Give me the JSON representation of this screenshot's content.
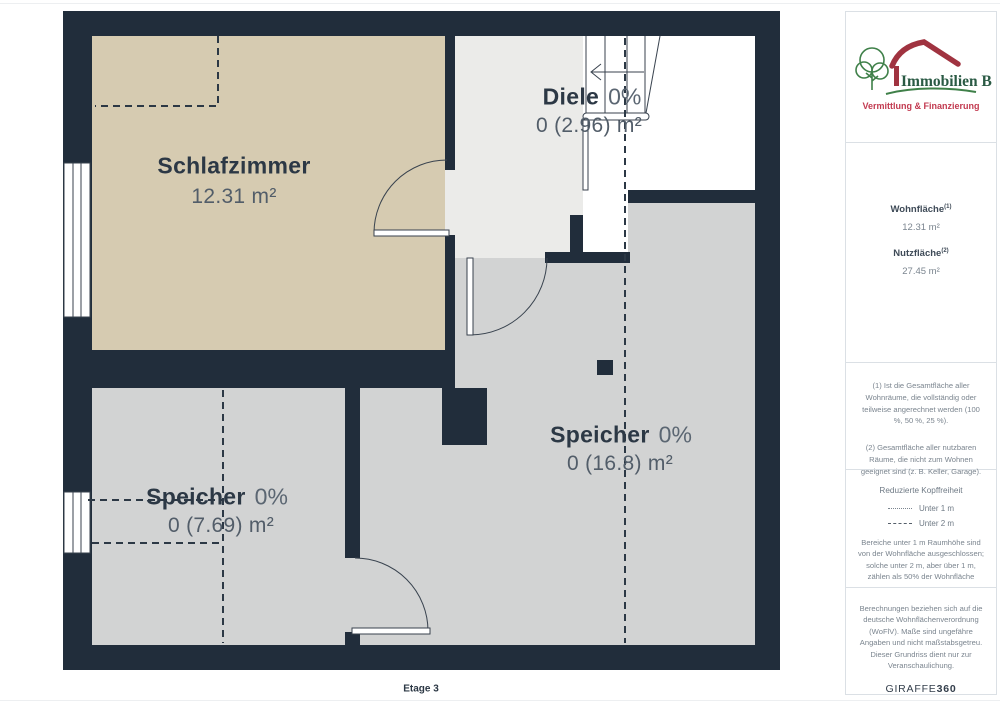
{
  "page": {
    "floor_label": "Etage 3"
  },
  "logo": {
    "name": "Immobilien Bart",
    "tagline": "Vermittlung & Finanzierung",
    "green": "#3f8049",
    "maroon": "#a03340",
    "red": "#c23a50"
  },
  "rooms": {
    "schlafzimmer": {
      "name": "Schlafzimmer",
      "area": "12.31 m²"
    },
    "diele": {
      "name": "Diele",
      "pct": "0%",
      "area": "0 (2.96) m²"
    },
    "speicher_right": {
      "name": "Speicher",
      "pct": "0%",
      "area": "0 (16.8) m²"
    },
    "speicher_left": {
      "name": "Speicher",
      "pct": "0%",
      "area": "0 (7.69) m²"
    }
  },
  "summary": {
    "wohnflaeche_label": "Wohnfläche",
    "wohnflaeche_sup": "(1)",
    "wohnflaeche_value": "12.31 m²",
    "nutzflaeche_label": "Nutzfläche",
    "nutzflaeche_sup": "(2)",
    "nutzflaeche_value": "27.45 m²"
  },
  "footnotes": {
    "note1": "(1) Ist die Gesamtfläche aller Wohnräume, die vollständig oder teilweise angerechnet werden (100 %, 50 %, 25 %).",
    "note2": "(2) Gesamtfläche aller nutzbaren Räume, die nicht zum Wohnen geeignet sind (z. B. Keller, Garage)."
  },
  "legend": {
    "title": "Reduzierte Kopffreiheit",
    "item1": "Unter 1 m",
    "item2": "Unter 2 m",
    "description": "Bereiche unter 1 m Raumhöhe sind von der Wohnfläche ausgeschlossen; solche unter 2 m, aber über 1 m, zählen als 50% der Wohnfläche"
  },
  "disclaimer": {
    "text": "Berechnungen beziehen sich auf die deutsche Wohnflächenverordnung (WoFlV). Maße sind ungefähre Angaben und nicht maßstabsgetreu. Dieser Grundriss dient nur zur Veranschaulichung.",
    "brand_normal": "GIRAFFE",
    "brand_bold": "360"
  },
  "colors": {
    "wall": "#212d3b",
    "bedroom": "#d6cbb1",
    "hall": "#ebebe9",
    "storage": "#d2d3d3",
    "stairwell": "#ffffff"
  }
}
